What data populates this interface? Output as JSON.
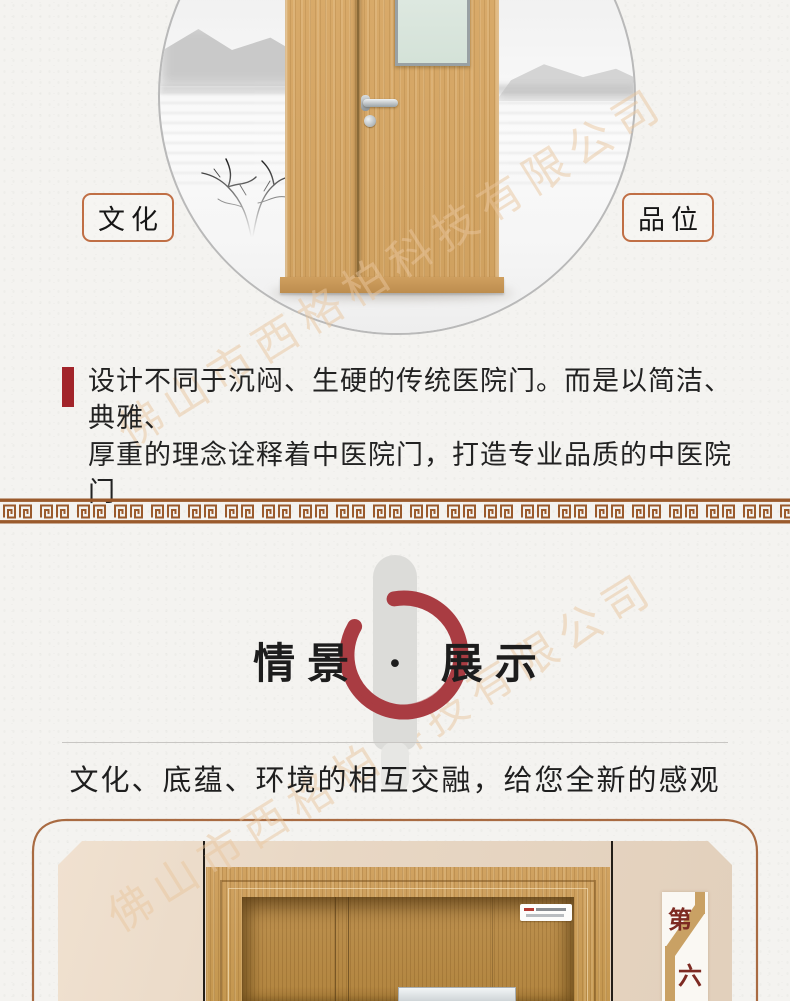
{
  "watermark": {
    "text": "佛山市西格柏科技有限公司",
    "color": "#eac79f"
  },
  "hero": {
    "left_label": "文化",
    "right_label": "品位",
    "description_line1": "设计不同于沉闷、生硬的传统医院门。而是以简洁、典雅、",
    "description_line2": "厚重的理念诠释着中医院门，打造专业品质的中医院门",
    "accent_color": "#a2242a",
    "label_border_color": "#c06f45"
  },
  "divider_pattern": {
    "style": "greek-key-meander",
    "color": "#9a5a2c"
  },
  "section": {
    "title": "情景 · 展示",
    "subtitle": "文化、底蕴、环境的相互交融，给您全新的感观",
    "enso_color": "#a93c42"
  },
  "showcase": {
    "badge_top_char": "第",
    "badge_bottom_char": "六",
    "badge_text_color": "#7d2a22",
    "badge_ribbon_color": "#c9a164",
    "frame_line_color": "#a96b42"
  }
}
